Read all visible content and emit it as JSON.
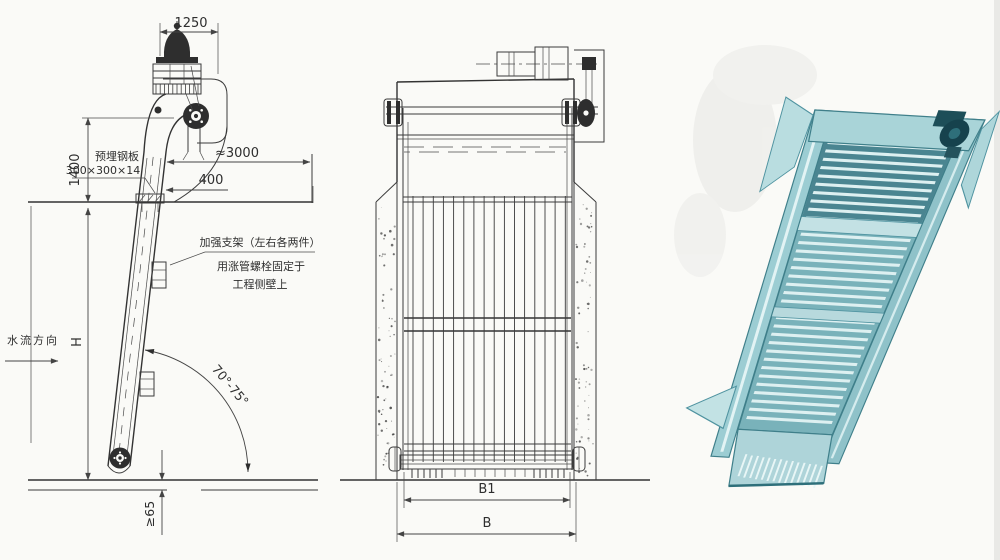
{
  "drawing": {
    "background": "#fafaf7",
    "ink_color": "#3b3b3b",
    "side_view": {
      "dims": {
        "head_width": "1250",
        "discharge_height": "1400",
        "platform_span": "≈3000",
        "plate_offset": "400",
        "channel_depth_label": "H",
        "install_angle": "70°-75°",
        "bottom_embed": "≥65"
      },
      "labels": {
        "flow_direction": "水流方向",
        "embedded_plate_1": "预埋钢板",
        "embedded_plate_2": "300×300×14",
        "brace_note_1": "加强支架（左右各两件）",
        "brace_note_2": "用涨管螺栓固定于",
        "brace_note_3": "工程侧壁上"
      }
    },
    "front_view": {
      "dims": {
        "screen_width": "B1",
        "channel_width": "B"
      }
    },
    "photo": {
      "palette": {
        "frame_light": "#c2e2e4",
        "frame_mid": "#9ccdd3",
        "panel": "#79b2ba",
        "panel_dark": "#4a8591",
        "outline": "#3f7f8a",
        "drive_dark": "#16424d"
      }
    }
  }
}
